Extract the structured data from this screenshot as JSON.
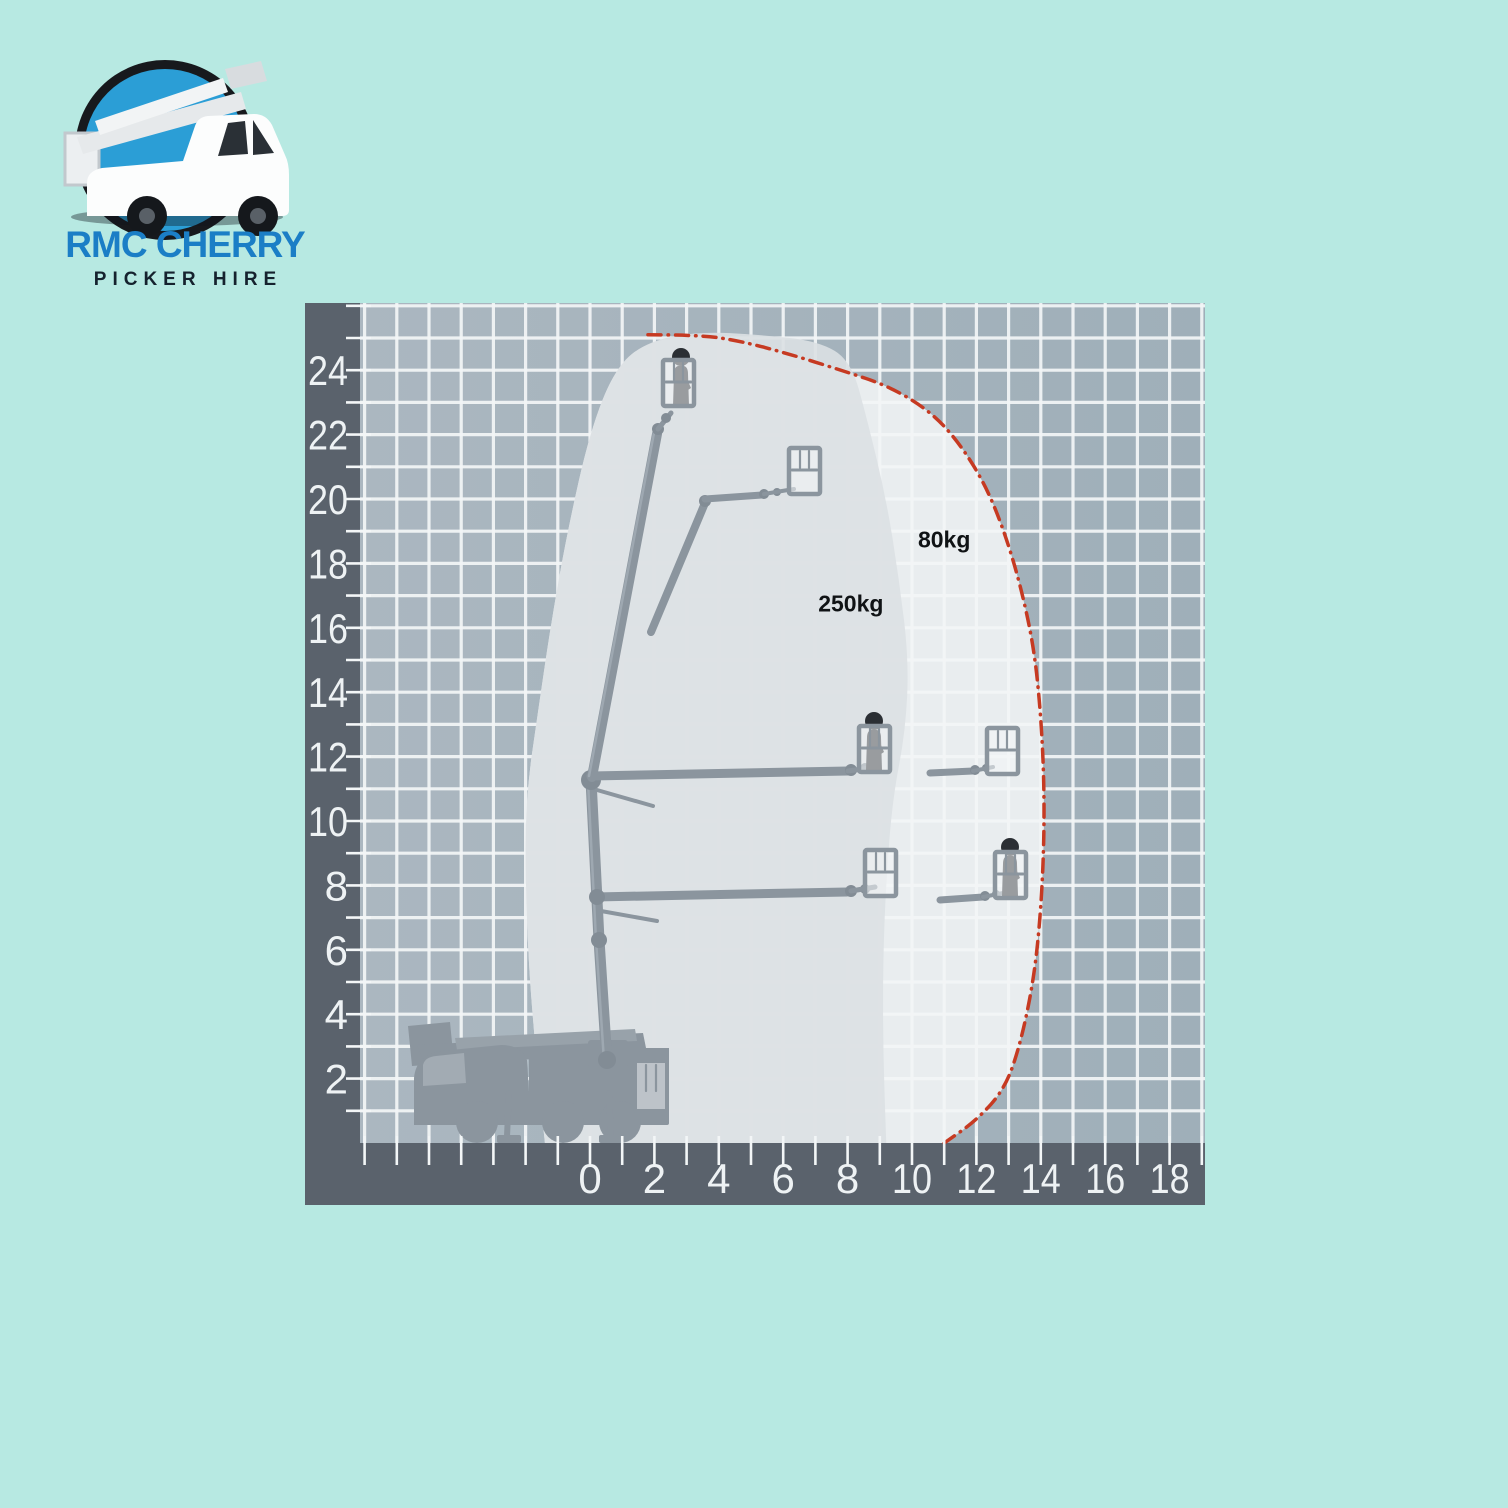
{
  "logo": {
    "line1": "RMC CHERRY",
    "line2": "PICKER HIRE",
    "colors": {
      "line1_color": "#1b7ec6",
      "line2_color": "#15222e",
      "circle_rim": "#17191d",
      "circle_fill": "#2b9ed6",
      "truck_body": "#fcfdfd"
    }
  },
  "chart_data": {
    "type": "area",
    "description": "Truck-mounted cherry picker working envelope: platform height (m) vs outreach (m)",
    "grid": true,
    "x_axis": {
      "unit": "m",
      "range": [
        -7.1,
        19.1
      ],
      "tick_step_minor": 1,
      "tick_values": [
        0,
        2,
        4,
        6,
        8,
        10,
        12,
        14,
        16,
        18
      ]
    },
    "y_axis": {
      "unit": "m",
      "range": [
        0,
        26.1
      ],
      "tick_step_minor": 1,
      "tick_values": [
        2,
        4,
        6,
        8,
        10,
        12,
        14,
        16,
        18,
        20,
        22,
        24
      ]
    },
    "zones": [
      {
        "label": "80kg",
        "label_pos": [
          11.0,
          18.5
        ],
        "boundary": [
          [
            -1.4,
            0
          ],
          [
            -1.8,
            3.8
          ],
          [
            -2.0,
            7.6
          ],
          [
            -2.0,
            10.7
          ],
          [
            -1.6,
            13.5
          ],
          [
            -1.2,
            16.2
          ],
          [
            -0.7,
            19.0
          ],
          [
            0.0,
            22.1
          ],
          [
            0.8,
            24.1
          ],
          [
            1.8,
            24.9
          ],
          [
            3.4,
            25.1
          ],
          [
            4.7,
            24.9
          ],
          [
            6.2,
            24.5
          ],
          [
            7.8,
            24.0
          ],
          [
            9.3,
            23.5
          ],
          [
            10.6,
            22.7
          ],
          [
            11.5,
            21.7
          ],
          [
            12.3,
            20.4
          ],
          [
            12.9,
            18.9
          ],
          [
            13.4,
            17.2
          ],
          [
            13.8,
            15.3
          ],
          [
            14.0,
            13.3
          ],
          [
            14.1,
            11.3
          ],
          [
            14.1,
            9.3
          ],
          [
            14.0,
            7.2
          ],
          [
            13.8,
            5.2
          ],
          [
            13.4,
            3.2
          ],
          [
            12.9,
            1.7
          ],
          [
            12.0,
            0.7
          ],
          [
            11.0,
            0
          ]
        ]
      },
      {
        "label": "250kg",
        "label_pos": [
          8.1,
          16.5
        ],
        "boundary": [
          [
            -1.4,
            0
          ],
          [
            -1.8,
            3.8
          ],
          [
            -2.0,
            7.6
          ],
          [
            -2.0,
            10.7
          ],
          [
            -1.6,
            13.5
          ],
          [
            -1.2,
            16.2
          ],
          [
            -0.7,
            19.0
          ],
          [
            0.0,
            22.1
          ],
          [
            0.8,
            24.1
          ],
          [
            1.8,
            24.9
          ],
          [
            3.4,
            25.2
          ],
          [
            5.3,
            25.1
          ],
          [
            7.1,
            24.9
          ],
          [
            8.1,
            24.3
          ],
          [
            8.6,
            22.5
          ],
          [
            9.2,
            20.0
          ],
          [
            9.6,
            17.5
          ],
          [
            9.9,
            15.0
          ],
          [
            9.8,
            12.8
          ],
          [
            9.4,
            10.7
          ],
          [
            9.2,
            8.2
          ],
          [
            9.1,
            5.7
          ],
          [
            9.1,
            2.9
          ],
          [
            9.2,
            0
          ]
        ]
      }
    ],
    "limit_line": [
      [
        1.8,
        25.1
      ],
      [
        3.4,
        25.1
      ],
      [
        4.7,
        24.9
      ],
      [
        6.2,
        24.5
      ],
      [
        7.8,
        24.0
      ],
      [
        9.3,
        23.5
      ],
      [
        10.6,
        22.7
      ],
      [
        11.5,
        21.7
      ],
      [
        12.3,
        20.4
      ],
      [
        12.9,
        18.9
      ],
      [
        13.4,
        17.2
      ],
      [
        13.8,
        15.3
      ],
      [
        14.0,
        13.3
      ],
      [
        14.1,
        11.3
      ],
      [
        14.1,
        9.3
      ],
      [
        14.0,
        7.2
      ],
      [
        13.8,
        5.2
      ],
      [
        13.4,
        3.2
      ],
      [
        12.9,
        1.7
      ],
      [
        12.0,
        0.7
      ],
      [
        11.0,
        0
      ]
    ],
    "platform_positions": [
      {
        "outreach": 2.6,
        "height": 22.8,
        "occupied": true
      },
      {
        "outreach": 6.3,
        "height": 20.2,
        "occupied": false
      },
      {
        "outreach": 8.4,
        "height": 11.6,
        "occupied": true
      },
      {
        "outreach": 12.3,
        "height": 11.6,
        "occupied": false
      },
      {
        "outreach": 8.6,
        "height": 7.7,
        "occupied": false
      },
      {
        "outreach": 12.6,
        "height": 7.7,
        "occupied": true
      }
    ],
    "colors": {
      "plot_base": "#a9b6c0",
      "plot_base_right": "#9fafb9",
      "axis_band": "#5a626c",
      "gridline": "#f3f6f7",
      "zone_80kg_fill": "#f3f5f6",
      "zone_250kg_fill": "#dce0e3",
      "limit_line_red": "#c63a22",
      "machine_gray": "#8b959e",
      "person_dark": "#2b2f34",
      "tick_label": "#eef2f4",
      "zone_label_text": "#101315"
    }
  }
}
